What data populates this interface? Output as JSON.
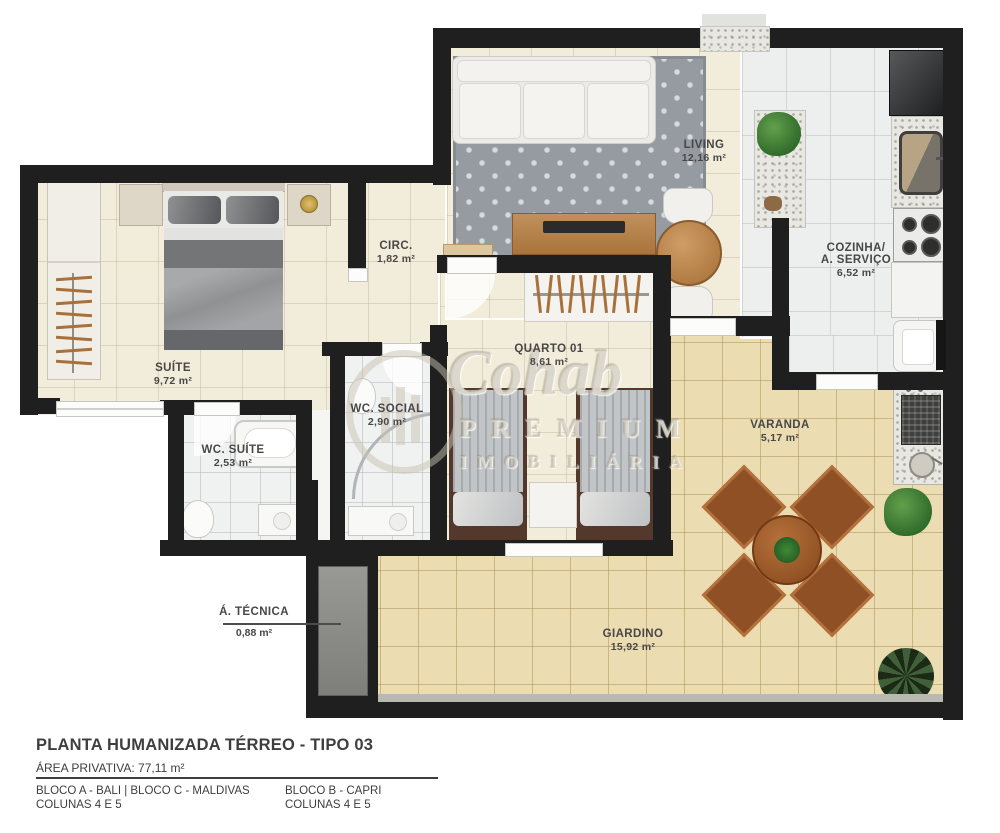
{
  "watermark": {
    "brand": "Cohab",
    "line1": "PREMIUM",
    "line2": "IMOBILIÁRIA"
  },
  "rooms": {
    "living": {
      "name": "LIVING",
      "area": "12,16 m²"
    },
    "circ": {
      "name": "CIRC.",
      "area": "1,82 m²"
    },
    "cozinha": {
      "name": "COZINHA/",
      "name2": "A. SERVIÇO",
      "area": "6,52 m²"
    },
    "suite": {
      "name": "SUÍTE",
      "area": "9,72 m²"
    },
    "quarto01": {
      "name": "QUARTO 01",
      "area": "8,61 m²"
    },
    "wc_social": {
      "name": "WC. SOCIAL",
      "area": "2,90 m²"
    },
    "wc_suite": {
      "name": "WC. SUÍTE",
      "area": "2,53 m²"
    },
    "varanda": {
      "name": "VARANDA",
      "area": "5,17 m²"
    },
    "giardino": {
      "name": "GIARDINO",
      "area": "15,92 m²"
    },
    "a_tecnica": {
      "name": "Á. TÉCNICA",
      "area": "0,88 m²"
    }
  },
  "footer": {
    "title": "PLANTA HUMANIZADA TÉRREO - TIPO 03",
    "private_area": "ÁREA PRIVATIVA: 77,11 m²",
    "columns": [
      {
        "line1": "BLOCO A - BALI | BLOCO C - MALDIVAS",
        "line2": "COLUNAS 4 E 5"
      },
      {
        "line1": "BLOCO B - CAPRI",
        "line2": "COLUNAS 4 E 5"
      }
    ]
  }
}
